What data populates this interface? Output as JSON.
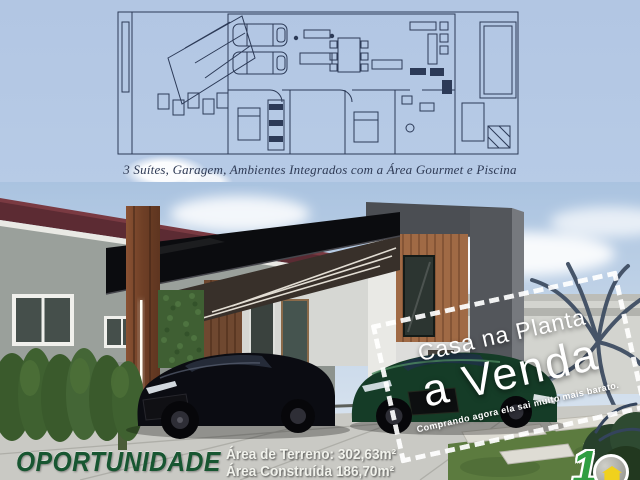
{
  "ad": {
    "floorplan_caption": "3 Suítes, Garagem, Ambientes Integrados com a Área Gourmet e Piscina",
    "badge": {
      "line1": "Casa na Planta",
      "line2": "a Venda",
      "tagline": "Comprando agora ela sai muito mais barato."
    },
    "footer": {
      "headline": "OPORTUNIDADE",
      "land_area": "Área de Terreno: 302,63m²",
      "built_area": "Área Construída 186,70m²"
    },
    "logo": {
      "numeral": "1"
    },
    "colors": {
      "sky": "#b4c8e4",
      "plan_lines": "#2c3a57",
      "caption_text": "#2e3a55",
      "headline_green": "#175631",
      "badge_text": "#ffffff",
      "canopy_black": "#0b0c0f",
      "neighbor_roof_maroon": "#5c2b33",
      "wood_pillar": "#8a5233",
      "car_black": "#0b0c12",
      "car_green": "#153c27",
      "pavement": "#c9c9c4",
      "grass": "#5c7b3f"
    }
  }
}
